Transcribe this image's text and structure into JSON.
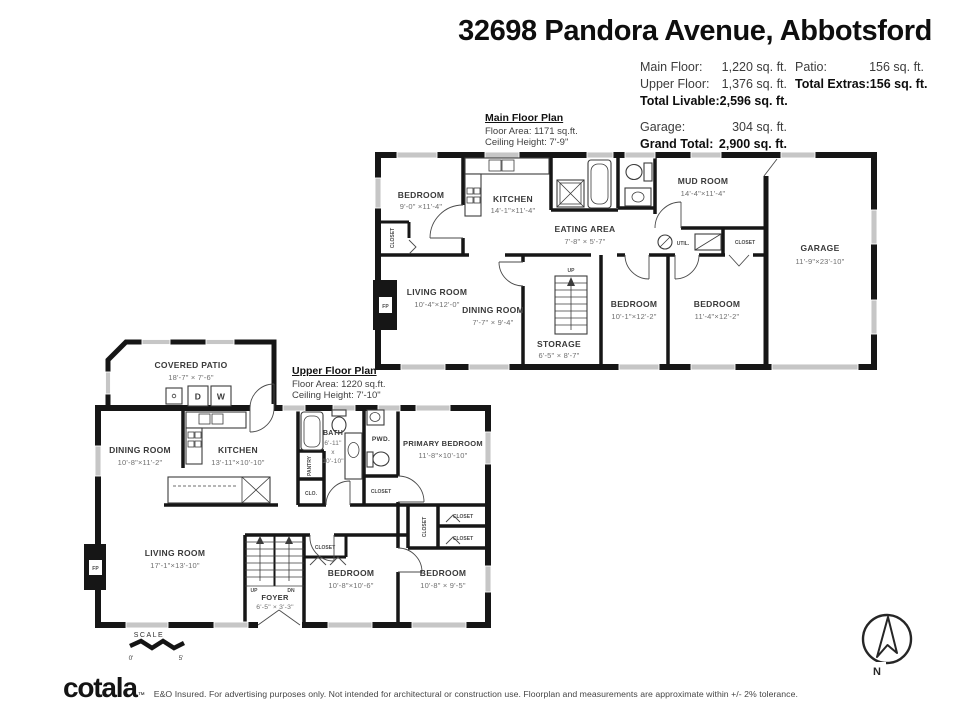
{
  "header": {
    "title": "32698 Pandora Avenue, Abbotsford"
  },
  "stats": {
    "rows_left": [
      {
        "label": "Main Floor:",
        "value": "1,220 sq. ft."
      },
      {
        "label": "Upper Floor:",
        "value": "1,376 sq. ft."
      },
      {
        "label": "Total Livable:",
        "value": "2,596 sq. ft."
      },
      {
        "label": "Garage:",
        "value": "304 sq. ft."
      },
      {
        "label": "Grand Total:",
        "value": "2,900 sq. ft."
      }
    ],
    "rows_right": [
      {
        "label": "Patio:",
        "value": "156 sq. ft."
      },
      {
        "label": "Total Extras:",
        "value": "156 sq. ft."
      }
    ]
  },
  "main_plan": {
    "title": "Main Floor Plan",
    "floor_area": "Floor Area: 1171 sq.ft.",
    "ceiling_height": "Ceiling Height: 7'-9\"",
    "bedroom_nw": {
      "name": "BEDROOM",
      "dims": "9'-0\" ×11'-4\""
    },
    "kitchen": {
      "name": "KITCHEN",
      "dims": "14'-1\"×11'-4\""
    },
    "eating_area": {
      "name": "EATING AREA",
      "dims": "7'-8\" × 5'-7\""
    },
    "mud_room": {
      "name": "MUD ROOM",
      "dims": "14'-4\"×11'-4\""
    },
    "garage": {
      "name": "GARAGE",
      "dims": "11'-9\"×23'-10\""
    },
    "living_room": {
      "name": "LIVING ROOM",
      "dims": "10'-4\"×12'-0\""
    },
    "dining_room": {
      "name": "DINING ROOM",
      "dims": "7'-7\" × 9'-4\""
    },
    "storage": {
      "name": "STORAGE",
      "dims": "6'-5\" × 8'-7\""
    },
    "bedroom_s1": {
      "name": "BEDROOM",
      "dims": "10'-1\"×12'-2\""
    },
    "bedroom_s2": {
      "name": "BEDROOM",
      "dims": "11'-4\"×12'-2\""
    },
    "closet_label": "CLOSET",
    "util_label": "UTIL.",
    "up_label": "UP",
    "fp_label": "FP"
  },
  "upper_plan": {
    "title": "Upper Floor Plan",
    "floor_area": "Floor Area: 1220 sq.ft.",
    "ceiling_height": "Ceiling Height: 7'-10\"",
    "covered_patio": {
      "name": "COVERED PATIO",
      "dims": "18'-7\" × 7'-6\""
    },
    "dining_room": {
      "name": "DINING ROOM",
      "dims": "10'-8\"×11'-2\""
    },
    "kitchen": {
      "name": "KITCHEN",
      "dims": "13'-11\"×10'-10\""
    },
    "bath": {
      "name": "BATH",
      "dims_l1": "6'-11\"",
      "dims_x": "x",
      "dims_l2": "10'-10\""
    },
    "pwd_label": "PWD.",
    "primary_bedroom": {
      "name": "PRIMARY BEDROOM",
      "dims": "11'-8\"×10'-10\""
    },
    "pantry_label": "PANTRY",
    "clo_label": "CLO.",
    "closet_label": "CLOSET",
    "living_room": {
      "name": "LIVING ROOM",
      "dims": "17'-1\"×13'-10\""
    },
    "foyer": {
      "name": "FOYER",
      "dims": "6'-5\" × 3'-3\""
    },
    "bedroom_1": {
      "name": "BEDROOM",
      "dims": "10'-8\"×10'-6\""
    },
    "bedroom_2": {
      "name": "BEDROOM",
      "dims": "10'-8\" × 9'-5\""
    },
    "dryer_label": "D",
    "washer_label": "W",
    "fp_label": "FP",
    "up_label": "UP",
    "dn_label": "DN"
  },
  "scale_bar": {
    "label": "SCALE",
    "zero": "0'",
    "five": "5'"
  },
  "compass": {
    "north": "N"
  },
  "footer": {
    "logo": "cotala",
    "trademark": "™",
    "disclaimer": "E&O Insured. For advertising purposes only. Not intended for architectural or construction use. Floorplan and measurements are approximate within +/- 2% tolerance."
  }
}
